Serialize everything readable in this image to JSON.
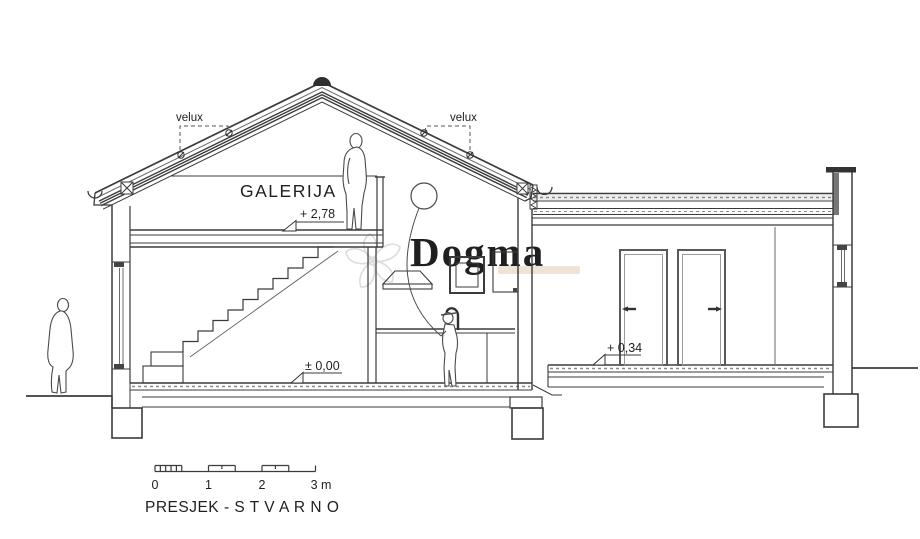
{
  "drawing": {
    "title": "PRESJEK - S T V A R N O",
    "room_label": "GALERIJA",
    "skylight_label_left": "velux",
    "skylight_label_right": "velux",
    "elevation_gallery": "+ 2,78",
    "elevation_ground": "± 0,00",
    "elevation_annex": "+ 0,34",
    "scale_bar": {
      "t0": "0",
      "t1": "1",
      "t2": "2",
      "t3": "3 m"
    },
    "watermark": {
      "text": "Dogma"
    },
    "colors": {
      "line": "#3b3b3b",
      "background": "#ffffff",
      "watermark_gray": "#dcdcdc",
      "watermark_accent": "#e8d9c8"
    }
  }
}
